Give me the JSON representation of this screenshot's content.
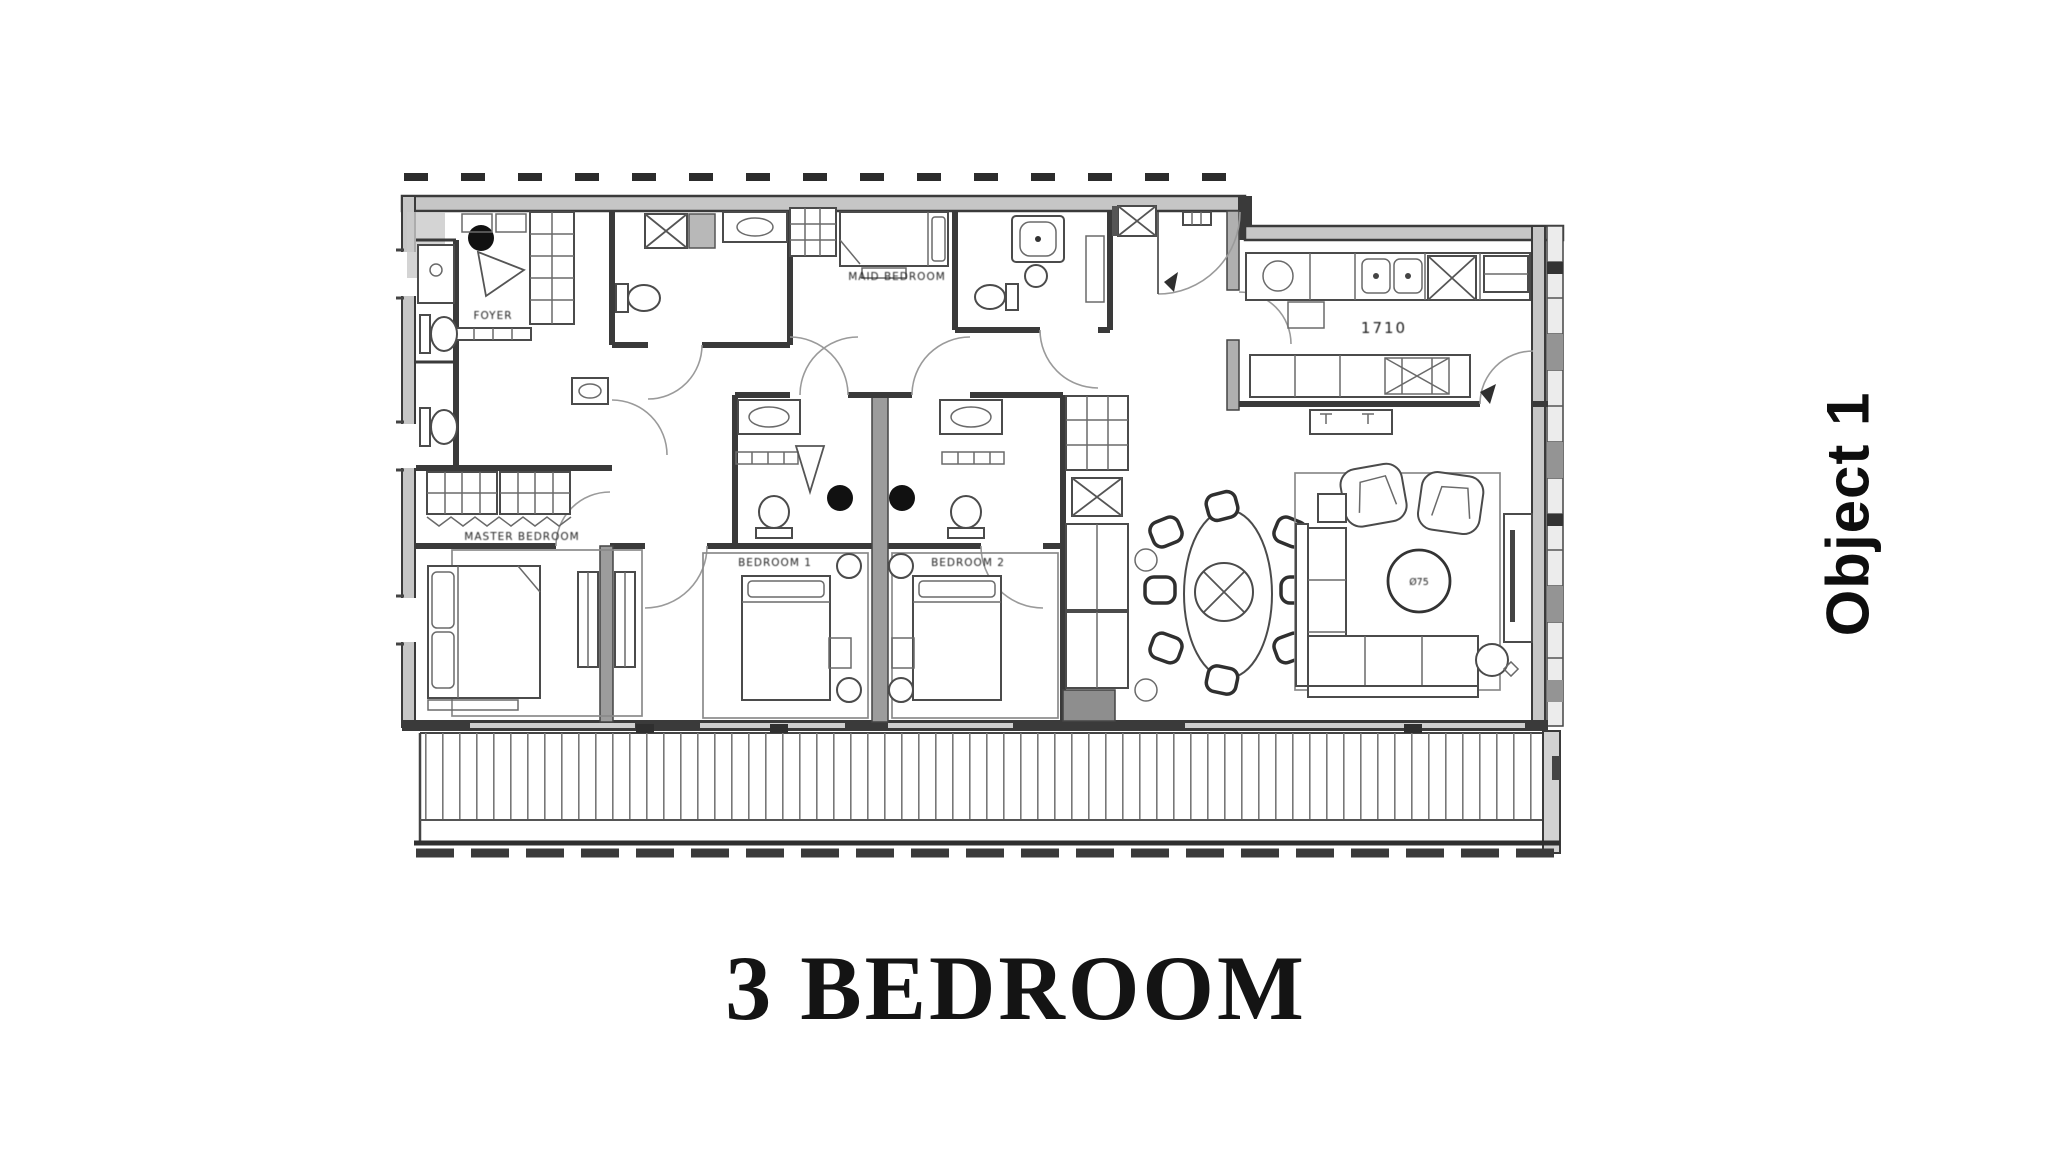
{
  "title": {
    "text": "3 BEDROOM"
  },
  "side_label": {
    "text": "Object 1"
  },
  "plan": {
    "type": "apartment-floor-plan",
    "labels": {
      "foyer": "FOYER",
      "master_bedroom": "MASTER BEDROOM",
      "bedroom1": "BEDROOM 1",
      "bedroom2": "BEDROOM 2",
      "maid_bedroom": "MAID BEDROOM",
      "kitchen_dim": "1710",
      "coffee_table": "Ø75"
    },
    "colors": {
      "ink": "#1c1c1c",
      "wall_dark": "#3a3a3a",
      "wall_fill": "#c6c6c6",
      "shaft_fill": "#9c9c9c",
      "background": "#ffffff"
    }
  }
}
